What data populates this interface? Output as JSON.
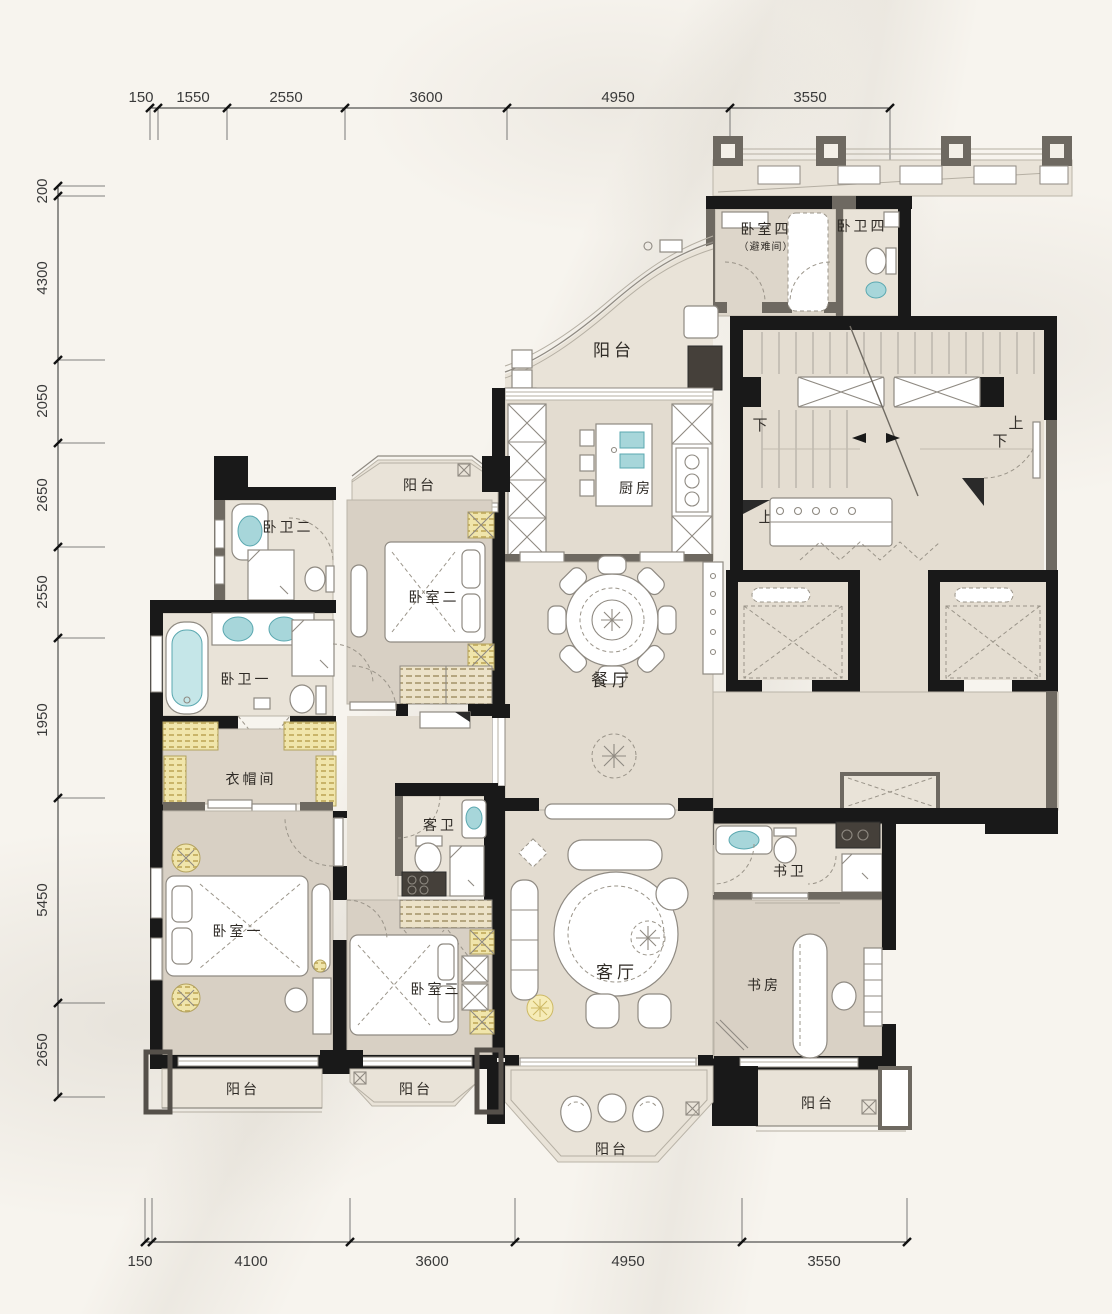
{
  "page": {
    "type": "residential-floor-plan"
  },
  "colors": {
    "background": "#f7f4ee",
    "wall": "#191919",
    "wall_secondary": "#6e6961",
    "floor_light": "#e9e3d8",
    "floor_mid": "#e3dcd0",
    "floor_bedroom": "#d8d0c4",
    "accent_yellow": "#f0e5ab",
    "fixture_teal": "#a7d6da",
    "line": "#8f8a82"
  },
  "dimensions": {
    "top": [
      "150",
      "1550",
      "2550",
      "3600",
      "4950",
      "3550"
    ],
    "left": [
      "200",
      "4300",
      "2050",
      "2650",
      "2550",
      "1950",
      "5450",
      "2650"
    ],
    "bottom": [
      "150",
      "4100",
      "3600",
      "4950",
      "3550"
    ]
  },
  "rooms": {
    "balcony_top": {
      "label": "阳台"
    },
    "bedroom4": {
      "label": "卧室四",
      "sublabel": "（避难间）"
    },
    "bath4": {
      "label": "卧卫四"
    },
    "kitchen": {
      "label": "厨房"
    },
    "balcony_upper_left": {
      "label": "阳台"
    },
    "bath2": {
      "label": "卧卫二"
    },
    "bedroom2": {
      "label": "卧室二"
    },
    "dining": {
      "label": "餐厅"
    },
    "bath1": {
      "label": "卧卫一"
    },
    "cloakroom": {
      "label": "衣帽间"
    },
    "guest_bath": {
      "label": "客卫"
    },
    "bedroom1": {
      "label": "卧室一"
    },
    "bedroom3": {
      "label": "卧室三"
    },
    "living": {
      "label": "客厅"
    },
    "study_bath": {
      "label": "书卫"
    },
    "study": {
      "label": "书房"
    },
    "balcony_bottom_left": {
      "label": "阳台"
    },
    "balcony_bottom_mid": {
      "label": "阳台"
    },
    "balcony_bottom_right": {
      "label": "阳台"
    },
    "balcony_bottom_center": {
      "label": "阳台"
    }
  },
  "stairs": {
    "down_left": "下",
    "up_right": "上",
    "down_right": "下",
    "up_left": "上"
  }
}
